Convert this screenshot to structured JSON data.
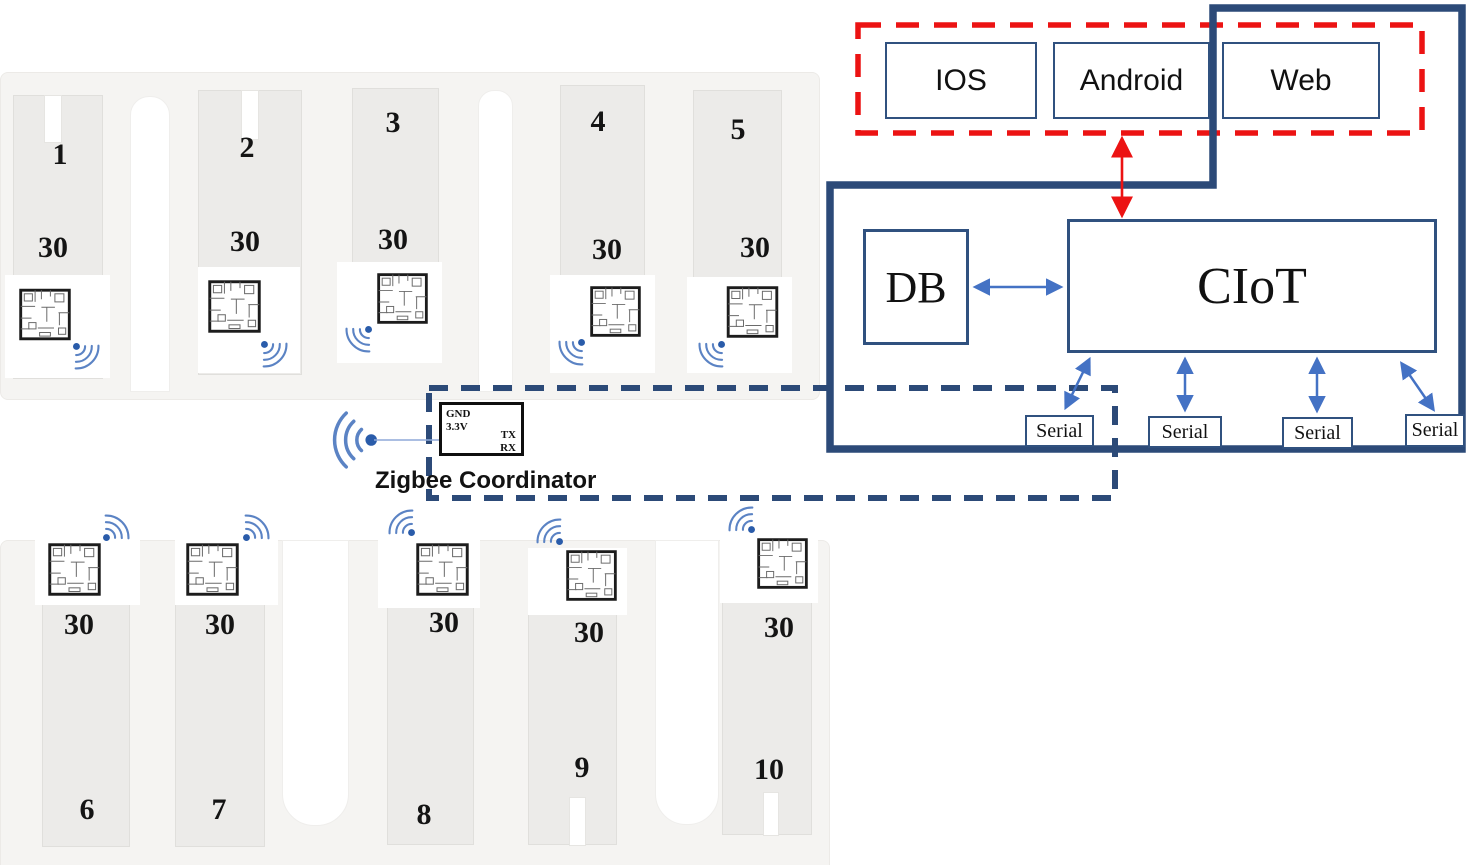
{
  "site": {
    "buildings": [
      {
        "number": "1",
        "floors": "30"
      },
      {
        "number": "2",
        "floors": "30"
      },
      {
        "number": "3",
        "floors": "30"
      },
      {
        "number": "4",
        "floors": "30"
      },
      {
        "number": "5",
        "floors": "30"
      },
      {
        "number": "6",
        "floors": "30"
      },
      {
        "number": "7",
        "floors": "30"
      },
      {
        "number": "8",
        "floors": "30"
      },
      {
        "number": "9",
        "floors": "30"
      },
      {
        "number": "10",
        "floors": "30"
      }
    ]
  },
  "coordinator": {
    "label": "Zigbee Coordinator",
    "pin_gnd": "GND",
    "pin_power": "3.3V",
    "pin_tx": "TX",
    "pin_rx": "RX"
  },
  "apps": {
    "ios": "IOS",
    "android": "Android",
    "web": "Web"
  },
  "cloud": {
    "db": "DB",
    "ciot": "CIoT",
    "serial": [
      "Serial",
      "Serial",
      "Serial",
      "Serial"
    ]
  },
  "colors": {
    "navy_border": "#2c4a78",
    "box_border": "#30517f",
    "arrow_blue": "#4472c4",
    "alert_red": "#ec1313",
    "wifi_blue": "#5b83c4"
  }
}
